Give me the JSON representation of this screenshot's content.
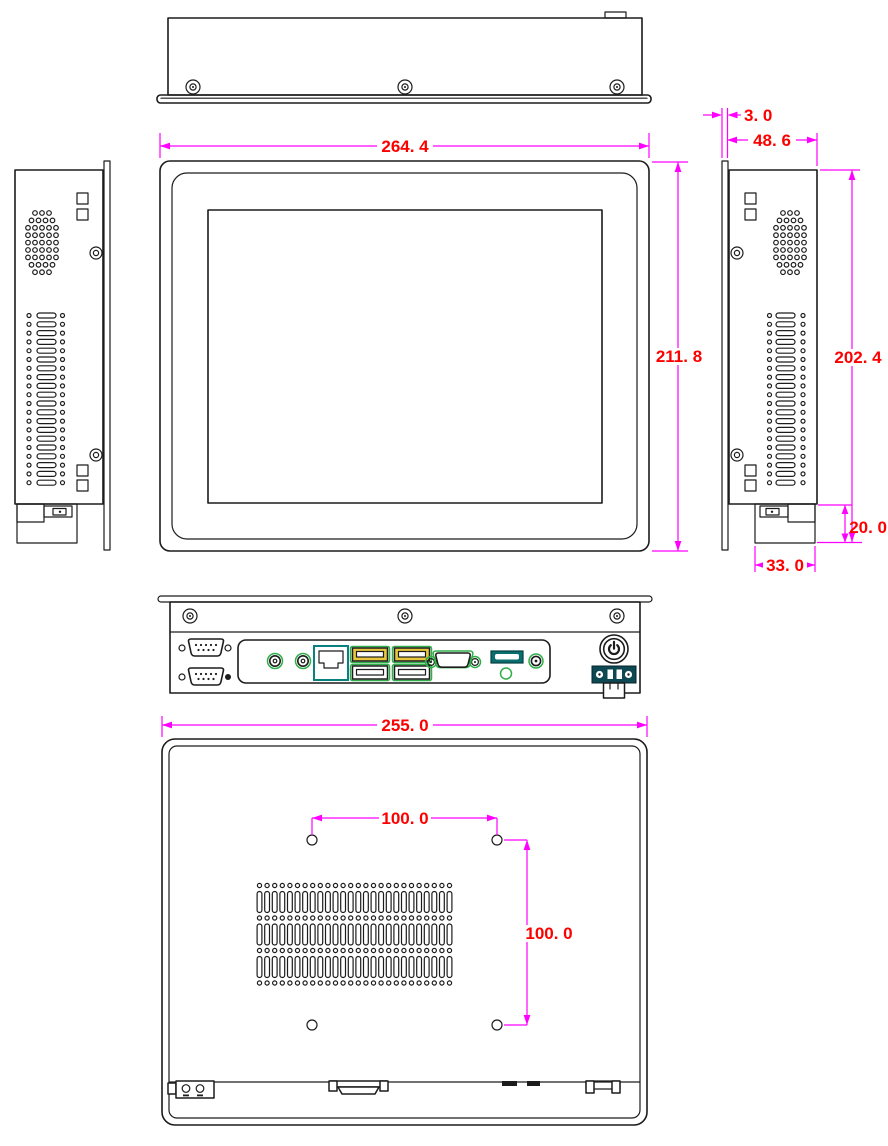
{
  "drawing": {
    "kind": "mechanical-dimension-drawing",
    "subject": "industrial-panel-pc",
    "colors": {
      "line": "#1c1c1c",
      "dimension_line": "#ff00ff",
      "dimension_text": "#fd0000",
      "port_green": "#2fae4a",
      "usb_yellow": "#e9c73e",
      "port_teal": "#0a6e6e",
      "terminal_dark": "#0e4852"
    },
    "dimensions": {
      "front_width": "264. 4",
      "front_height": "211. 8",
      "bezel_thickness": "3. 0",
      "body_depth": "48. 6",
      "side_height": "202. 4",
      "bottom_connector_height": "20. 0",
      "bottom_connector_width": "33. 0",
      "rear_width": "255. 0",
      "vesa_horizontal": "100. 0",
      "vesa_vertical": "100. 0"
    },
    "io_ports": [
      "serial-db9-port",
      "serial-db9-port",
      "audio-jack",
      "audio-jack",
      "ethernet-rj45-port",
      "usb-port-pair",
      "usb-port-pair",
      "vga-port",
      "hdmi-port",
      "antenna-connector",
      "power-button",
      "power-terminal-block"
    ]
  }
}
